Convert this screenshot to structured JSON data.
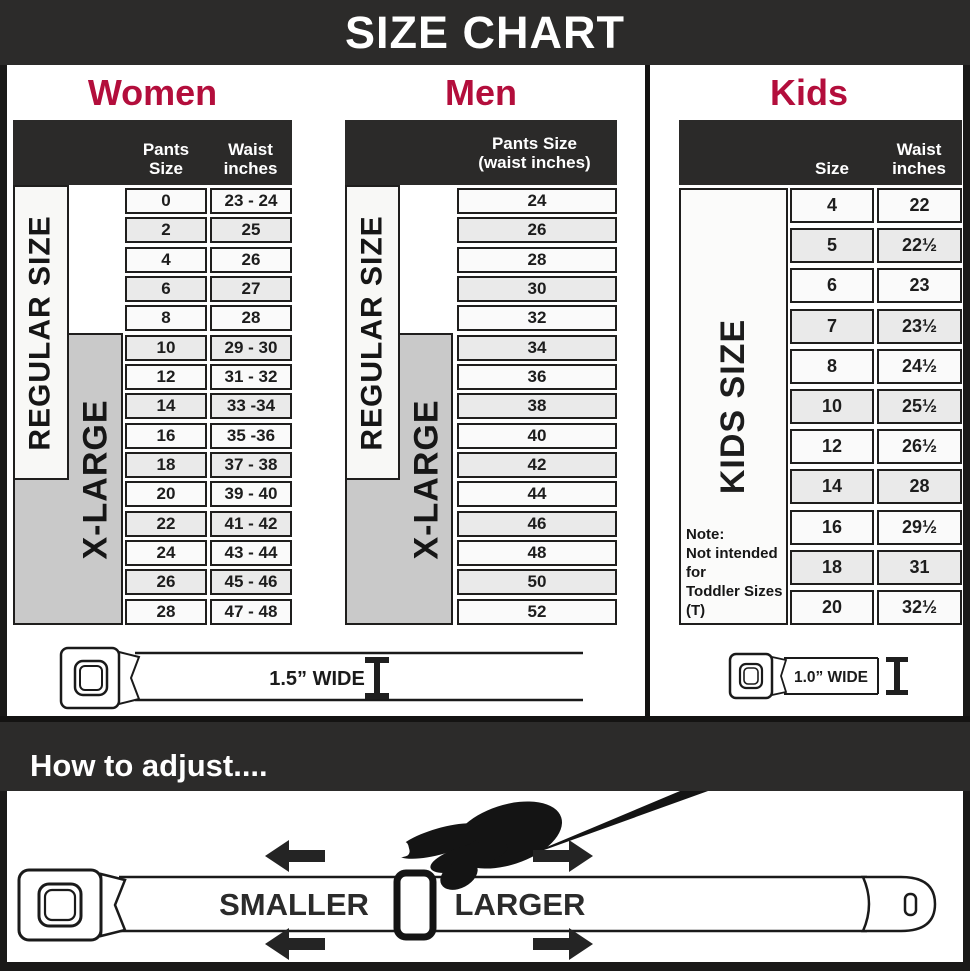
{
  "title": "SIZE CHART",
  "colors": {
    "accent_red": "#b30e3c",
    "dark_bar": "#2c2b2a",
    "xlarge_gray": "#c9c9c9"
  },
  "sections": {
    "women": {
      "heading": "Women",
      "col1_header": "Pants Size",
      "col2_header_line1": "Waist",
      "col2_header_line2": "inches",
      "regular_label": "REGULAR SIZE",
      "xlarge_label": "X-LARGE",
      "rows": [
        {
          "size": "0",
          "waist": "23 - 24"
        },
        {
          "size": "2",
          "waist": "25"
        },
        {
          "size": "4",
          "waist": "26"
        },
        {
          "size": "6",
          "waist": "27"
        },
        {
          "size": "8",
          "waist": "28"
        },
        {
          "size": "10",
          "waist": "29 - 30"
        },
        {
          "size": "12",
          "waist": "31 - 32"
        },
        {
          "size": "14",
          "waist": "33 -34"
        },
        {
          "size": "16",
          "waist": "35 -36"
        },
        {
          "size": "18",
          "waist": "37 - 38"
        },
        {
          "size": "20",
          "waist": "39 - 40"
        },
        {
          "size": "22",
          "waist": "41 - 42"
        },
        {
          "size": "24",
          "waist": "43 - 44"
        },
        {
          "size": "26",
          "waist": "45 - 46"
        },
        {
          "size": "28",
          "waist": "47 - 48"
        }
      ]
    },
    "men": {
      "heading": "Men",
      "header_line1": "Pants Size",
      "header_line2": "(waist inches)",
      "regular_label": "REGULAR SIZE",
      "xlarge_label": "X-LARGE",
      "rows": [
        "24",
        "26",
        "28",
        "30",
        "32",
        "34",
        "36",
        "38",
        "40",
        "42",
        "44",
        "46",
        "48",
        "50",
        "52"
      ]
    },
    "kids": {
      "heading": "Kids",
      "col1_header": "Size",
      "col2_header_line1": "Waist",
      "col2_header_line2": "inches",
      "label": "KIDS SIZE",
      "note_line1": "Note:",
      "note_line2": "Not intended for",
      "note_line3": "Toddler Sizes (T)",
      "rows": [
        {
          "size": "4",
          "waist": "22"
        },
        {
          "size": "5",
          "waist": "22½"
        },
        {
          "size": "6",
          "waist": "23"
        },
        {
          "size": "7",
          "waist": "23½"
        },
        {
          "size": "8",
          "waist": "24½"
        },
        {
          "size": "10",
          "waist": "25½"
        },
        {
          "size": "12",
          "waist": "26½"
        },
        {
          "size": "14",
          "waist": "28"
        },
        {
          "size": "16",
          "waist": "29½"
        },
        {
          "size": "18",
          "waist": "31"
        },
        {
          "size": "20",
          "waist": "32½"
        }
      ]
    }
  },
  "belts": {
    "adult_width_label": "1.5” WIDE",
    "kids_width_label": "1.0” WIDE"
  },
  "adjust": {
    "heading": "How to adjust....",
    "smaller_label": "SMALLER",
    "larger_label": "LARGER"
  }
}
